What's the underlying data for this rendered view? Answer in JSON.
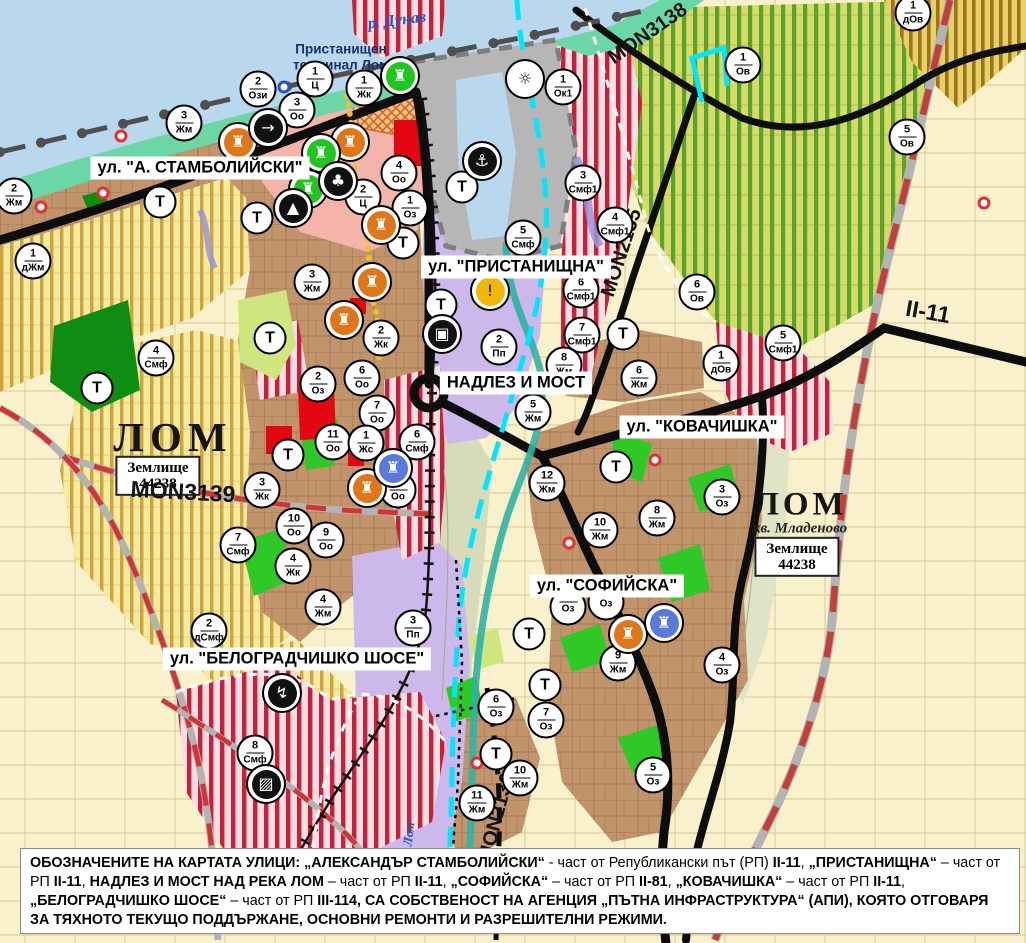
{
  "palette": {
    "water": "#b9d8ee",
    "shore": "#6bd7a6",
    "port": "#b6b6b6",
    "urban": "#c2946b",
    "urbanLine": "#86613f",
    "fields": "#f9f1cc",
    "fieldLine": "#d6c692",
    "vinBase": "#d8d967",
    "vinStripe": "#55a42d",
    "yelBase": "#f7e9a0",
    "yelStripe": "#c7992a",
    "smfBase": "#f8dde3",
    "smfStripe": "#c7203a",
    "dovBase": "#e7d06b",
    "dovStripe": "#9b7516",
    "pinkC": "#f4b4a9",
    "lavender": "#ccb8ea",
    "flood": "#d8dbb9",
    "flood2": "#e0e4c6",
    "green": "#2ec927",
    "darkgreen": "#0f8c12",
    "lightgreen": "#cfe67e",
    "red": "#e30613",
    "road": "#0d0d0d",
    "roadRed": "#d23333",
    "roadGray": "#b3b3b3",
    "rail": "#4f4f4f",
    "riverLom": "#2fb3a5",
    "cyan": "#00e6ff",
    "yellowDots": "#f0c020",
    "purpleRoad": "#9f93d8"
  },
  "labels": {
    "river_danube": "р. Дунав",
    "port_terminal": "Пристанищен\nтерминал Лом",
    "city_west": "ЛОМ",
    "city_east": "ЛОМ",
    "district": "кв. Младеново",
    "plot_line1": "Землище",
    "plot_line2": "44238",
    "river_lom": "Лом"
  },
  "roads": {
    "m3138": "MON3138",
    "m2135": "MON2135",
    "m3139": "MON3139",
    "m2136": "MON2136",
    "ii11": "II-11"
  },
  "streets": [
    {
      "text": "ул. \"А. СТАМБОЛИЙСКИ\"",
      "x": 200,
      "y": 168
    },
    {
      "text": "ул. \"ПРИСТАНИЩНА\"",
      "x": 516,
      "y": 267
    },
    {
      "text": "НАДЛЕЗ И МОСТ",
      "x": 516,
      "y": 383
    },
    {
      "text": "ул. \"КОВАЧИШКА\"",
      "x": 702,
      "y": 427
    },
    {
      "text": "ул. \"СОФИЙСКА\"",
      "x": 607,
      "y": 586
    },
    {
      "text": "ул. \"БЕЛОГРАДЧИШКО ШОСЕ\"",
      "x": 297,
      "y": 659
    }
  ],
  "markers": [
    {
      "n": "2",
      "c": "Жм",
      "x": 14,
      "y": 196
    },
    {
      "n": "1",
      "c": "дЖм",
      "x": 33,
      "y": 261
    },
    {
      "n": "3",
      "c": "Жм",
      "x": 184,
      "y": 123
    },
    {
      "n": "2",
      "c": "Ози",
      "x": 258,
      "y": 89
    },
    {
      "n": "1",
      "c": "Ц",
      "x": 315,
      "y": 79
    },
    {
      "n": "3",
      "c": "Оо",
      "x": 297,
      "y": 110
    },
    {
      "n": "1",
      "c": "Жк",
      "x": 364,
      "y": 88
    },
    {
      "n": "4",
      "c": "Оо",
      "x": 399,
      "y": 173
    },
    {
      "n": "2",
      "c": "Ц",
      "x": 363,
      "y": 197
    },
    {
      "n": "1",
      "c": "Оз",
      "x": 410,
      "y": 208
    },
    {
      "n": "4",
      "c": "Смф",
      "x": 156,
      "y": 358
    },
    {
      "n": "3",
      "c": "Жм",
      "x": 312,
      "y": 282
    },
    {
      "n": "2",
      "c": "Жк",
      "x": 381,
      "y": 338
    },
    {
      "n": "6",
      "c": "Оо",
      "x": 362,
      "y": 378
    },
    {
      "n": "2",
      "c": "Оз",
      "x": 318,
      "y": 384
    },
    {
      "n": "7",
      "c": "Оо",
      "x": 377,
      "y": 413
    },
    {
      "n": "11",
      "c": "Оо",
      "x": 333,
      "y": 442
    },
    {
      "n": "1",
      "c": "Жс",
      "x": 366,
      "y": 443
    },
    {
      "n": "6",
      "c": "Смф",
      "x": 417,
      "y": 442
    },
    {
      "n": "8",
      "c": "Оо",
      "x": 398,
      "y": 490
    },
    {
      "n": "3",
      "c": "Жк",
      "x": 262,
      "y": 490
    },
    {
      "n": "10",
      "c": "Оо",
      "x": 294,
      "y": 526
    },
    {
      "n": "9",
      "c": "Оо",
      "x": 326,
      "y": 540
    },
    {
      "n": "4",
      "c": "Жк",
      "x": 293,
      "y": 566
    },
    {
      "n": "7",
      "c": "Смф",
      "x": 238,
      "y": 545
    },
    {
      "n": "4",
      "c": "Жм",
      "x": 323,
      "y": 607
    },
    {
      "n": "2",
      "c": "дСмф",
      "x": 209,
      "y": 631
    },
    {
      "n": "3",
      "c": "Пп",
      "x": 413,
      "y": 628
    },
    {
      "n": "8",
      "c": "Смф",
      "x": 255,
      "y": 753
    },
    {
      "n": "5",
      "c": "Смф",
      "x": 523,
      "y": 238
    },
    {
      "n": "3",
      "c": "Смф1",
      "x": 583,
      "y": 183
    },
    {
      "n": "4",
      "c": "Смф1",
      "x": 615,
      "y": 225
    },
    {
      "n": "6",
      "c": "Смф1",
      "x": 581,
      "y": 290
    },
    {
      "n": "7",
      "c": "Смф1",
      "x": 582,
      "y": 335
    },
    {
      "n": "2",
      "c": "Пп",
      "x": 499,
      "y": 347
    },
    {
      "n": "8",
      "c": "Жм",
      "x": 564,
      "y": 365
    },
    {
      "n": "5",
      "c": "Жм",
      "x": 533,
      "y": 412
    },
    {
      "n": "6",
      "c": "Жм",
      "x": 639,
      "y": 378
    },
    {
      "n": "6",
      "c": "Ов",
      "x": 697,
      "y": 292
    },
    {
      "n": "1",
      "c": "дОв",
      "x": 721,
      "y": 363
    },
    {
      "n": "5",
      "c": "Смф1",
      "x": 783,
      "y": 343
    },
    {
      "n": "1",
      "c": "Ок1",
      "x": 563,
      "y": 87
    },
    {
      "n": "1",
      "c": "Ов",
      "x": 743,
      "y": 65
    },
    {
      "n": "5",
      "c": "Ов",
      "x": 907,
      "y": 137
    },
    {
      "n": "1",
      "c": "дОв",
      "x": 913,
      "y": 13
    },
    {
      "n": "12",
      "c": "Жм",
      "x": 547,
      "y": 483
    },
    {
      "n": "10",
      "c": "Жм",
      "x": 600,
      "y": 530
    },
    {
      "n": "8",
      "c": "Жм",
      "x": 657,
      "y": 518
    },
    {
      "n": "3",
      "c": "Оз",
      "x": 722,
      "y": 497
    },
    {
      "n": "9",
      "c": "Жм",
      "x": 618,
      "y": 663
    },
    {
      "n": "4",
      "c": "Оз",
      "x": 722,
      "y": 665
    },
    {
      "n": "6",
      "c": "Оз",
      "x": 496,
      "y": 707
    },
    {
      "n": "7",
      "c": "Оз",
      "x": 546,
      "y": 720
    },
    {
      "n": "5",
      "c": "Оз",
      "x": 653,
      "y": 775
    },
    {
      "n": "10",
      "c": "Жм",
      "x": 520,
      "y": 778
    },
    {
      "n": "11",
      "c": "Жм",
      "x": 477,
      "y": 803
    },
    {
      "n": "",
      "c": "Оз",
      "x": 568,
      "y": 607
    },
    {
      "n": "",
      "c": "Оз",
      "x": 606,
      "y": 602
    },
    {
      "c": "Т",
      "x": 160,
      "y": 202
    },
    {
      "c": "Т",
      "x": 257,
      "y": 218
    },
    {
      "c": "Т",
      "x": 403,
      "y": 243
    },
    {
      "c": "Т",
      "x": 441,
      "y": 305
    },
    {
      "c": "Т",
      "x": 270,
      "y": 338
    },
    {
      "c": "Т",
      "x": 97,
      "y": 388
    },
    {
      "c": "Т",
      "x": 288,
      "y": 455
    },
    {
      "c": "Т",
      "x": 462,
      "y": 187
    },
    {
      "c": "Т",
      "x": 623,
      "y": 334
    },
    {
      "c": "Т",
      "x": 616,
      "y": 467
    },
    {
      "c": "Т",
      "x": 529,
      "y": 634
    },
    {
      "c": "Т",
      "x": 545,
      "y": 685
    },
    {
      "c": "Т",
      "x": 496,
      "y": 754
    }
  ],
  "poi": [
    {
      "name": "heritage-icon",
      "glyph": "♜",
      "bg": "#e0761a",
      "fg": "#ffffff",
      "x": 238,
      "y": 142
    },
    {
      "name": "heritage-icon",
      "glyph": "♜",
      "bg": "#e0761a",
      "fg": "#ffffff",
      "x": 350,
      "y": 142
    },
    {
      "name": "heritage-icon",
      "glyph": "♜",
      "bg": "#e0761a",
      "fg": "#ffffff",
      "x": 381,
      "y": 225
    },
    {
      "name": "heritage-icon",
      "glyph": "♜",
      "bg": "#e0761a",
      "fg": "#ffffff",
      "x": 372,
      "y": 282
    },
    {
      "name": "heritage-icon",
      "glyph": "♜",
      "bg": "#e0761a",
      "fg": "#ffffff",
      "x": 344,
      "y": 320
    },
    {
      "name": "heritage-icon",
      "glyph": "♜",
      "bg": "#e0761a",
      "fg": "#ffffff",
      "x": 367,
      "y": 488
    },
    {
      "name": "heritage-icon",
      "glyph": "♜",
      "bg": "#e0761a",
      "fg": "#ffffff",
      "x": 628,
      "y": 634
    },
    {
      "name": "heritage-green-icon",
      "glyph": "♜",
      "bg": "#22c41f",
      "fg": "#ffffff",
      "x": 400,
      "y": 76
    },
    {
      "name": "heritage-green-icon",
      "glyph": "♜",
      "bg": "#22c41f",
      "fg": "#ffffff",
      "x": 321,
      "y": 153
    },
    {
      "name": "heritage-green-icon",
      "glyph": "♜",
      "bg": "#22c41f",
      "fg": "#ffffff",
      "x": 308,
      "y": 189
    },
    {
      "name": "heritage-blue-icon",
      "glyph": "♜",
      "bg": "#5b79d8",
      "fg": "#ffffff",
      "x": 393,
      "y": 468
    },
    {
      "name": "heritage-blue-icon",
      "glyph": "♜",
      "bg": "#5b79d8",
      "fg": "#ffffff",
      "x": 664,
      "y": 623
    },
    {
      "name": "key-icon",
      "glyph": "→",
      "bg": "#111111",
      "fg": "#ffffff",
      "x": 268,
      "y": 128
    },
    {
      "name": "clover-icon",
      "glyph": "♣",
      "bg": "#111111",
      "fg": "#ffffff",
      "x": 338,
      "y": 181
    },
    {
      "name": "tunnel-icon",
      "glyph": "▲",
      "bg": "#111111",
      "fg": "#ffffff",
      "x": 293,
      "y": 208
    },
    {
      "name": "anchor-icon",
      "glyph": "⚓",
      "bg": "#111111",
      "fg": "#ffffff",
      "x": 482,
      "y": 161
    },
    {
      "name": "sun-icon",
      "glyph": "☼",
      "bg": "#ffffff",
      "fg": "#111111",
      "x": 525,
      "y": 79
    },
    {
      "name": "warning-icon",
      "glyph": "!",
      "bg": "#f2b705",
      "fg": "#111111",
      "x": 490,
      "y": 291
    },
    {
      "name": "truck-icon",
      "glyph": "▣",
      "bg": "#111111",
      "fg": "#ffffff",
      "x": 442,
      "y": 334
    },
    {
      "name": "power-icon",
      "glyph": "↯",
      "bg": "#111111",
      "fg": "#ffffff",
      "x": 282,
      "y": 693
    },
    {
      "name": "hatched-icon",
      "glyph": "▨",
      "bg": "#111111",
      "fg": "#ffffff",
      "x": 266,
      "y": 784
    }
  ],
  "nodes": [
    {
      "kind": "red",
      "x": 121,
      "y": 136
    },
    {
      "kind": "red",
      "x": 103,
      "y": 193
    },
    {
      "kind": "red",
      "x": 41,
      "y": 207
    },
    {
      "kind": "red",
      "x": 655,
      "y": 460
    },
    {
      "kind": "red",
      "x": 569,
      "y": 543
    },
    {
      "kind": "red",
      "x": 477,
      "y": 763
    },
    {
      "kind": "red",
      "x": 984,
      "y": 203
    },
    {
      "kind": "blue",
      "x": 284,
      "y": 87
    }
  ],
  "footer": {
    "segments": [
      {
        "b": 1,
        "t": "ОБОЗНАЧЕНИТЕ НА КАРТАТА УЛИЦИ: „АЛЕКСАНДЪР СТАМБОЛИЙСКИ“"
      },
      {
        "b": 0,
        "t": " - част от Републикански път (РП) "
      },
      {
        "b": 1,
        "t": "II-11"
      },
      {
        "b": 0,
        "t": ", "
      },
      {
        "b": 1,
        "t": "„ПРИСТАНИЩНА“"
      },
      {
        "b": 0,
        "t": " – част от РП "
      },
      {
        "b": 1,
        "t": "II-11"
      },
      {
        "b": 0,
        "t": ", "
      },
      {
        "b": 1,
        "t": "НАДЛЕЗ И МОСТ НАД РЕКА ЛОМ"
      },
      {
        "b": 0,
        "t": " – част от РП "
      },
      {
        "b": 1,
        "t": "II-11"
      },
      {
        "b": 0,
        "t": ", "
      },
      {
        "b": 1,
        "t": "„СОФИЙСКА“"
      },
      {
        "b": 0,
        "t": " – част от РП "
      },
      {
        "b": 1,
        "t": "II-81"
      },
      {
        "b": 0,
        "t": ", "
      },
      {
        "b": 1,
        "t": "„КОВАЧИШКА“"
      },
      {
        "b": 0,
        "t": " – част от РП "
      },
      {
        "b": 1,
        "t": "II-11"
      },
      {
        "b": 0,
        "t": ", "
      },
      {
        "b": 1,
        "t": "„БЕЛОГРАДЧИШКО ШОСЕ“"
      },
      {
        "b": 0,
        "t": " – част от РП "
      },
      {
        "b": 1,
        "t": "III-114"
      },
      {
        "b": 1,
        "t": ", СА СОБСТВЕНОСТ НА АГЕНЦИЯ „ПЪТНА ИНФРАСТРУКТУРА“ (АПИ), КОЯТО ОТГОВАРЯ ЗА ТЯХНОТО ТЕКУЩО ПОДДЪРЖАНЕ, ОСНОВНИ РЕМОНТИ И РАЗРЕШИТЕЛНИ РЕЖИМИ."
      }
    ]
  }
}
